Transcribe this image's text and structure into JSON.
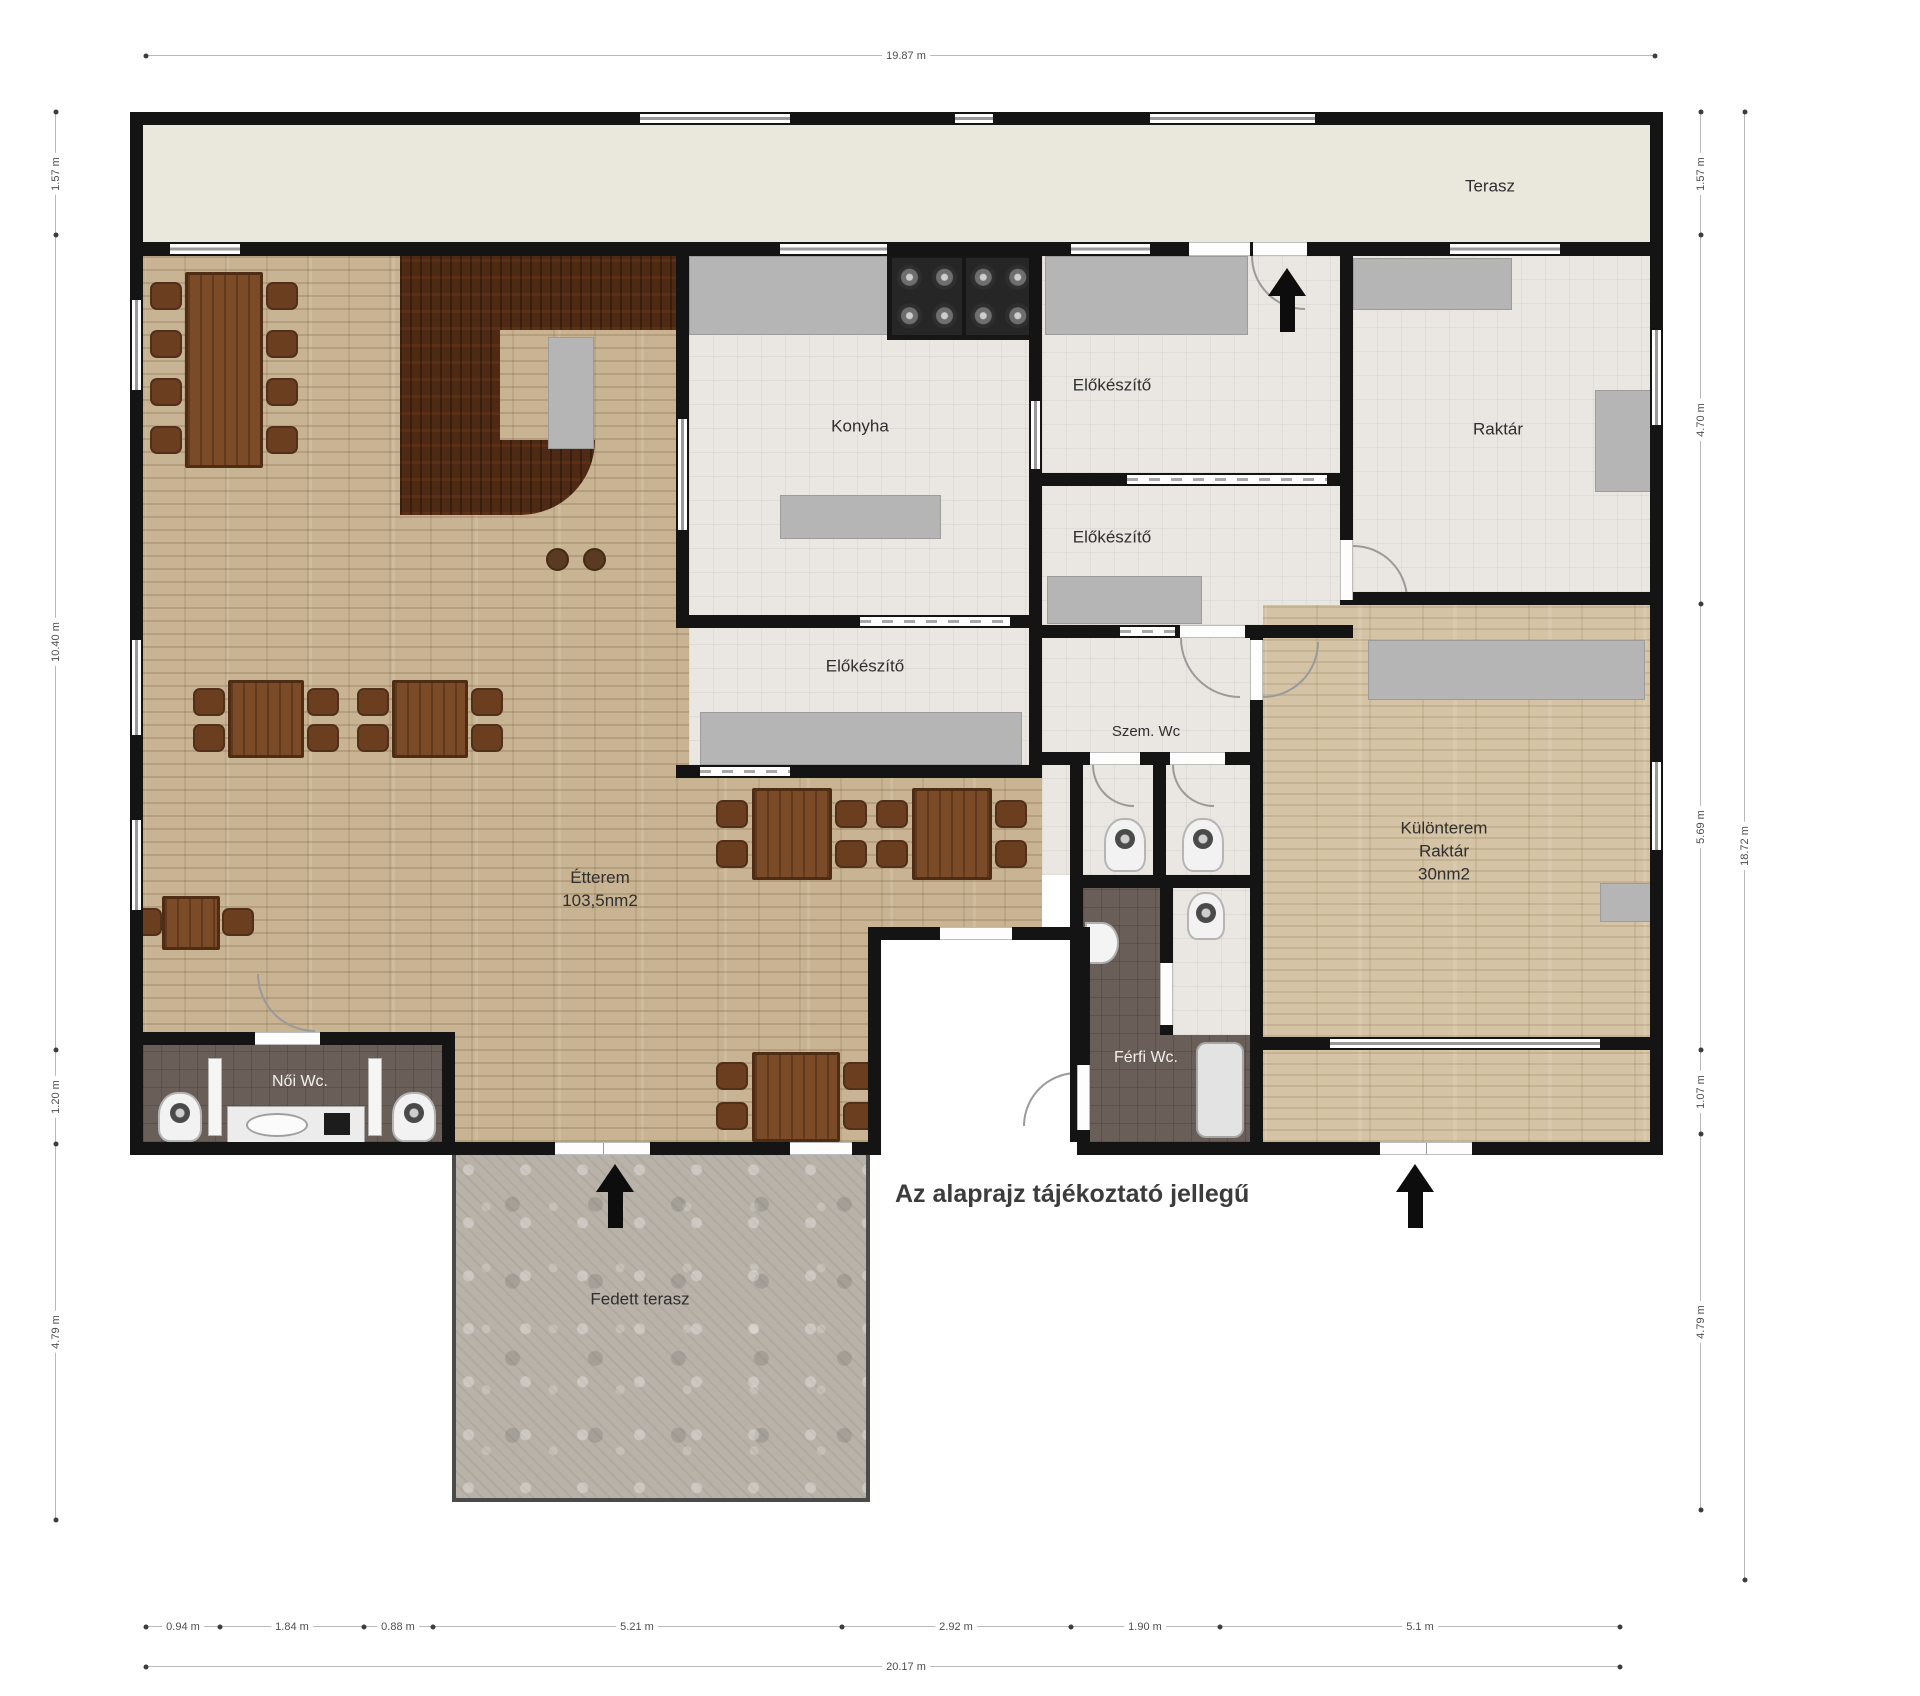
{
  "labels": {
    "terasz": "Terasz",
    "konyha": "Konyha",
    "elokeszito_1": "Előkészítő",
    "elokeszito_2": "Előkészítő",
    "elokeszito_3": "Előkészítő",
    "raktar": "Raktár",
    "szem_wc": "Szem. Wc",
    "etterem_name": "Étterem",
    "etterem_area": "103,5nm2",
    "kulonterem_line1": "Különterem",
    "kulonterem_line2": "Raktár",
    "kulonterem_line3": "30nm2",
    "noi_wc": "Női Wc.",
    "ferfi_wc": "Férfi Wc.",
    "fedett_terasz": "Fedett terasz",
    "disclaimer": "Az alaprajz tájékoztató jellegű"
  },
  "dimensions": {
    "top_total": "19.87 m",
    "bottom_total": "20.17 m",
    "right_total": "18.72 m",
    "left": [
      "1.57 m",
      "10.40 m",
      "1.20 m",
      "4.79 m"
    ],
    "right": [
      "1.57 m",
      "4.70 m",
      "5.69 m",
      "1.07 m",
      "4.79 m"
    ],
    "bottom": [
      "0.94 m",
      "1.84 m",
      "0.88 m",
      "5.21 m",
      "2.92 m",
      "1.90 m",
      "5.1 m"
    ]
  }
}
